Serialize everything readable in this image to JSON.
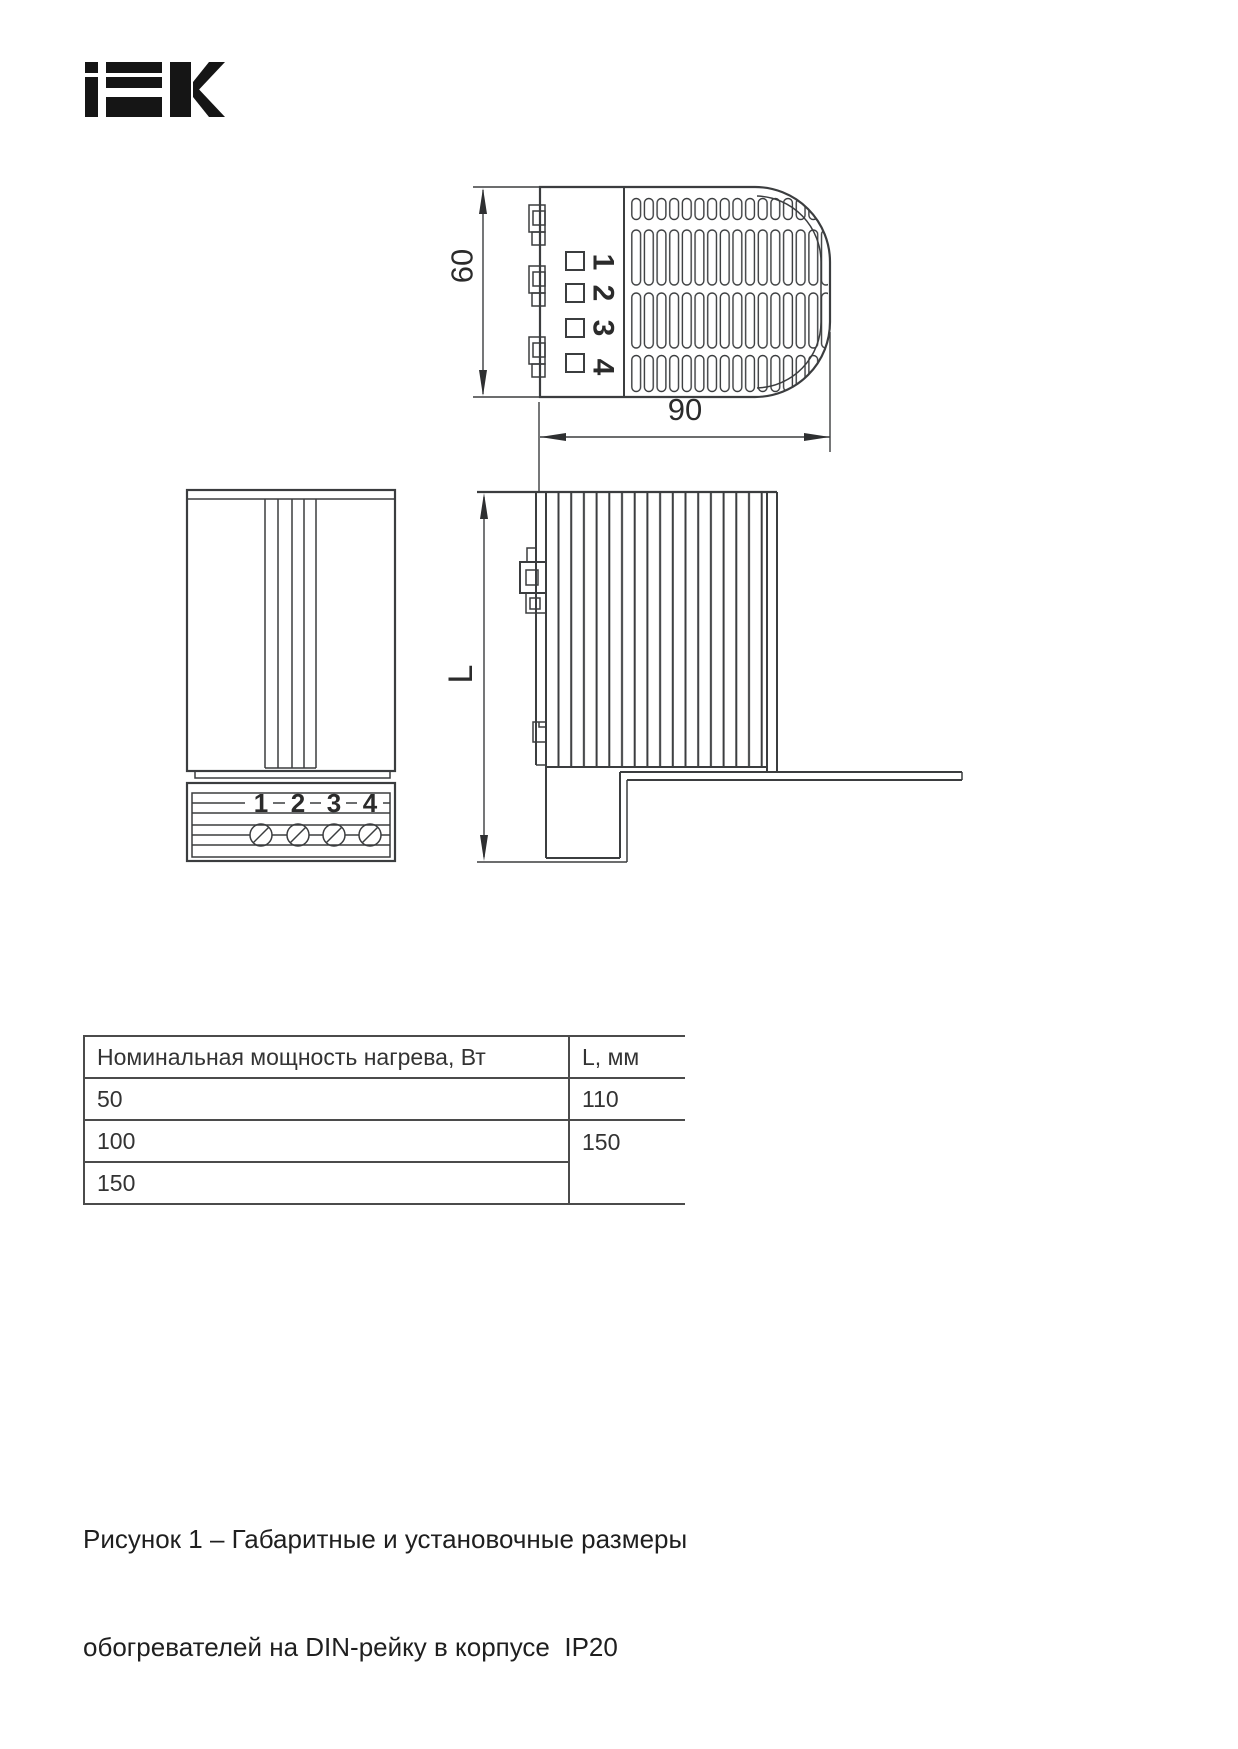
{
  "page": {
    "background": "#ffffff"
  },
  "logo": {
    "brand": "IEK",
    "color": "#151515"
  },
  "drawing": {
    "line_color": "#3b3d3f",
    "top_view": {
      "height_dim": "60",
      "width_dim": "90",
      "terminals": [
        "1",
        "2",
        "3",
        "4"
      ]
    },
    "front_view": {
      "terminals": [
        "1",
        "2",
        "3",
        "4"
      ]
    },
    "side_view": {
      "length_dim": "L"
    }
  },
  "table": {
    "col1_header": "Номинальная мощность нагрева, Вт",
    "col2_header": "L, мм",
    "rows": [
      {
        "power": "50",
        "length": "110"
      },
      {
        "power": "100",
        "length": "150"
      },
      {
        "power": "150"
      }
    ]
  },
  "caption": {
    "line1": "Рисунок 1 – Габаритные и установочные размеры",
    "line2": "обогревателей на DIN-рейку в корпусе  IP20"
  }
}
